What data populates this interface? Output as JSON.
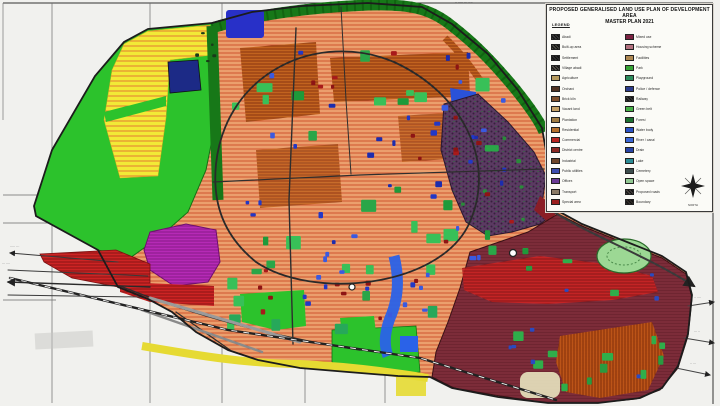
{
  "page": {
    "background": "#f1f1ee"
  },
  "map": {
    "top_label": "·· ····· ··· ····",
    "left_label_1": "····· ···",
    "left_label_2": "··· ····",
    "mid_label": "··· ··",
    "right_label_1": "·· ····",
    "right_label_2": "··· ··",
    "right_label_3": "·· ···"
  },
  "palette": {
    "agricultural_green": "#2cc22c",
    "residential_salmon": "#eb9f6d",
    "orchard_yellow": "#f2ea36",
    "builtup_orange": "#c2631f",
    "greenbelt_dark": "#177818",
    "industrial_purple": "#5b3a62",
    "old_city_maroon": "#6f2531",
    "commercial_red": "#cc2424",
    "water_blue": "#2a62e8",
    "special_magenta": "#b62ab6"
  },
  "legend": {
    "title_line1": "PROPOSED GENERALISED LAND USE PLAN OF DEVELOPMENT AREA",
    "title_line2": "MASTER PLAN 2021",
    "heading": "LEGEND",
    "compass_label": "NORTH",
    "columns": {
      "left": [
        {
          "label": "Abadi",
          "color": "#3a3a3a",
          "textured": true
        },
        {
          "label": "Built-up area",
          "color": "#4a4a42",
          "textured": true
        },
        {
          "label": "Settlement",
          "color": "#2f2f2f",
          "textured": true
        },
        {
          "label": "Village abadi",
          "color": "#55514a",
          "textured": true
        },
        {
          "label": "Agriculture",
          "color": "#b59a5e"
        },
        {
          "label": "Orchard",
          "color": "#4f3222"
        },
        {
          "label": "Brick kiln",
          "color": "#7d4e2c"
        },
        {
          "label": "Vacant land",
          "color": "#c4a066"
        },
        {
          "label": "Plantation",
          "color": "#a07c42"
        },
        {
          "label": "Residential",
          "color": "#b4702c"
        },
        {
          "label": "Commercial",
          "color": "#b82622"
        },
        {
          "label": "District centre",
          "color": "#8c2a24"
        },
        {
          "label": "Industrial",
          "color": "#6e452a"
        },
        {
          "label": "Public utilities",
          "color": "#3c4cae"
        },
        {
          "label": "Offices",
          "color": "#6a3a96"
        },
        {
          "label": "Transport",
          "color": "#8a7a66"
        },
        {
          "label": "Special area",
          "color": "#9c1f1f"
        }
      ],
      "right": [
        {
          "label": "Mixed use",
          "color": "#7c2242"
        },
        {
          "label": "Housing scheme",
          "color": "#b2707e"
        },
        {
          "label": "Facilities",
          "color": "#ae8852"
        },
        {
          "label": "Park",
          "color": "#36a436"
        },
        {
          "label": "Playground",
          "color": "#2c8c5c"
        },
        {
          "label": "Police / defence",
          "color": "#2c3c8c"
        },
        {
          "label": "Railway",
          "color": "#3a3a3a",
          "textured": true
        },
        {
          "label": "Green belt",
          "color": "#46b046"
        },
        {
          "label": "Forest",
          "color": "#1c7030"
        },
        {
          "label": "Water body",
          "color": "#2a52c6"
        },
        {
          "label": "River / canal",
          "color": "#3a66d6"
        },
        {
          "label": "Drain",
          "color": "#2844a6"
        },
        {
          "label": "Lake",
          "color": "#2c8c96"
        },
        {
          "label": "Cemetery",
          "color": "#3c4c4c"
        },
        {
          "label": "Open space",
          "color": "#92c892"
        },
        {
          "label": "Proposed roads",
          "color": "#4a4440",
          "textured": true
        },
        {
          "label": "Boundary",
          "color": "#35302b",
          "textured": true
        }
      ]
    }
  }
}
